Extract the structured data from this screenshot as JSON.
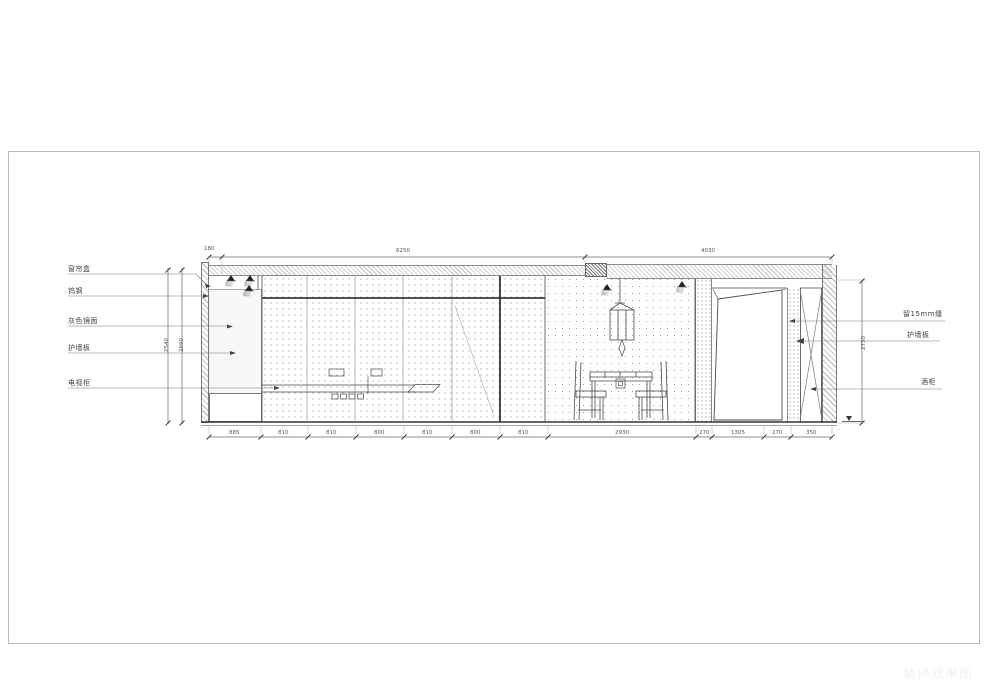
{
  "labels_left": {
    "curtain_box": "窗帘盒",
    "metal_trim": "钨钢",
    "gray_mirror": "灰色镜面",
    "wall_panel": "护墙板",
    "tv_cabinet": "电视柜"
  },
  "labels_right": {
    "gap": "留15mm缝",
    "wall_panel": "护墙板",
    "wine_cabinet": "酒柜"
  },
  "dims": {
    "top": {
      "d1": "180",
      "d2": "6250",
      "d3": "4030"
    },
    "bottom": [
      "885",
      "810",
      "810",
      "800",
      "810",
      "800",
      "810",
      "2930",
      "270",
      "1305",
      "270",
      "350"
    ],
    "left_vertical": {
      "inner": "2540",
      "outer": "2690"
    },
    "right_vertical": "2730"
  },
  "fixtures": {
    "downlight_label": "筒灯"
  },
  "watermark": "装修效果图",
  "colors": {
    "line": "#4a4a4a",
    "heavy_line": "#333333",
    "hatch": "#8a8a8a",
    "paper": "#ffffff"
  }
}
